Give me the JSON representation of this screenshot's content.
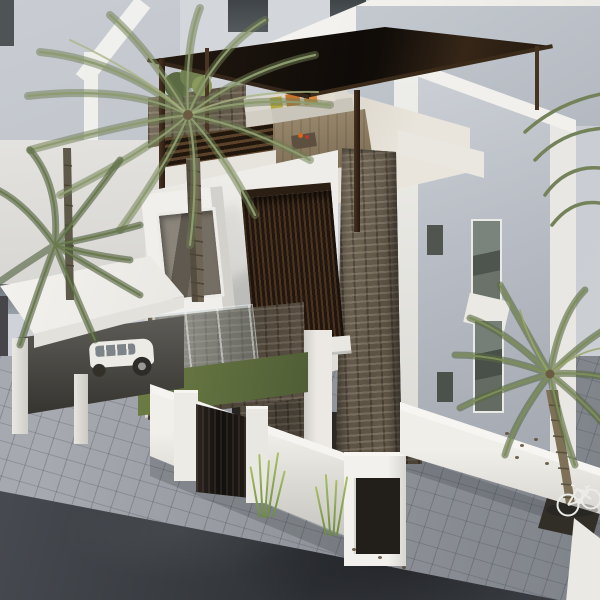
{
  "scene": {
    "domain": "natural-image",
    "title": "Aerial 3D render of a modern white villa with rooftop pergola and palm trees",
    "camera": "high three-quarter aerial view",
    "time_of_day": "daytime, sunlight from upper right",
    "objects": [
      {
        "name": "villa",
        "description": "modern white two/three storey house with flat roofs"
      },
      {
        "name": "rooftop-pergola",
        "description": "dark brown flat canopy on timber posts over roof terrace"
      },
      {
        "name": "terrace-seating",
        "description": "L-shaped sofa with grey cushions and orange pillows on wood deck rug"
      },
      {
        "name": "louver-screen",
        "description": "dark vertical timber louver panel on front facade"
      },
      {
        "name": "stone-column",
        "description": "tall stacked-stone clad feature column"
      },
      {
        "name": "window-box",
        "description": "protruding white frame window with recessed glazing"
      },
      {
        "name": "carport",
        "description": "white flat slab carport sheltering a white car"
      },
      {
        "name": "perimeter-wall",
        "description": "white boundary wall with dark entry gate and corner pillar niche"
      },
      {
        "name": "courtyard",
        "description": "grass strip, glass balustrade and stone walls behind the fence"
      },
      {
        "name": "sidewalk",
        "description": "grey concrete paver sidewalk band"
      },
      {
        "name": "road",
        "description": "dark asphalt street at lower left"
      },
      {
        "name": "palm-trees",
        "description": "large palm upper-left, small palm mid-left, palm at lower-right"
      },
      {
        "name": "bicycle",
        "description": "white bicycle leaning at palm near sidewalk planter"
      },
      {
        "name": "background-buildings",
        "description": "neighbouring white and grey buildings"
      }
    ],
    "palette": {
      "white_sunlit": "#f2f1ed",
      "white_neutral": "#e7e5e0",
      "grey_facade": "#b9bdc5",
      "canopy_dark": "#1c130c",
      "timber_post": "#3c2b1e",
      "louver_brown": "#34241664",
      "stone_brown": "#6f6452",
      "grass_green": "#6d7d44",
      "palm_green": "#7f8f60",
      "paver_grey": "#90949a",
      "asphalt": "#34373c",
      "pillow_orange": "#c9732f"
    }
  }
}
